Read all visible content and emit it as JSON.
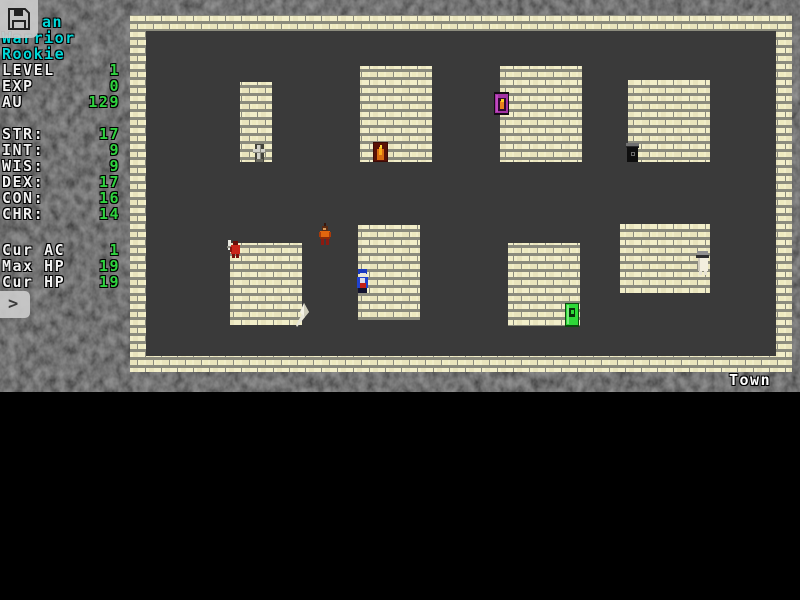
{
  "app": {
    "prompt_char": ">",
    "save_icon": "floppy-disk"
  },
  "colors": {
    "accent_cyan": "#00d9d9",
    "accent_green": "#2fd33f",
    "text_white": "#f2f2f2",
    "brick_light": "#f2eec9",
    "brick_dark": "#e9e4bd",
    "mortar": "#8b8b7d",
    "floor": "#3a3a3a",
    "background": "#141414"
  },
  "sidebar": {
    "prompt_char": ">",
    "title_lines": [
      {
        "text": "an",
        "indent": 40
      },
      {
        "text": "Warrior",
        "indent": 0
      },
      {
        "text": "Rookie",
        "indent": 0
      }
    ],
    "blocks": [
      {
        "top": 62,
        "rows": [
          {
            "label": "LEVEL",
            "value": "1"
          },
          {
            "label": "EXP",
            "value": "0"
          },
          {
            "label": "AU",
            "value": "129"
          }
        ]
      },
      {
        "top": 126,
        "rows": [
          {
            "label": "STR:",
            "value": "17"
          },
          {
            "label": "INT:",
            "value": "9"
          },
          {
            "label": "WIS:",
            "value": "9"
          },
          {
            "label": "DEX:",
            "value": "17"
          },
          {
            "label": "CON:",
            "value": "16"
          },
          {
            "label": "CHR:",
            "value": "14"
          }
        ]
      },
      {
        "top": 242,
        "rows": [
          {
            "label": "Cur AC",
            "value": "1"
          },
          {
            "label": "Max HP",
            "value": "19"
          },
          {
            "label": "Cur HP",
            "value": "19"
          }
        ]
      }
    ]
  },
  "map": {
    "label": "Town",
    "buildings": [
      {
        "x": 110,
        "y": 67,
        "w": 32,
        "h": 80
      },
      {
        "x": 230,
        "y": 51,
        "w": 72,
        "h": 96
      },
      {
        "x": 370,
        "y": 51,
        "w": 82,
        "h": 96
      },
      {
        "x": 498,
        "y": 65,
        "w": 82,
        "h": 82
      },
      {
        "x": 100,
        "y": 228,
        "w": 72,
        "h": 82
      },
      {
        "x": 228,
        "y": 210,
        "w": 62,
        "h": 95
      },
      {
        "x": 378,
        "y": 228,
        "w": 72,
        "h": 83
      },
      {
        "x": 490,
        "y": 209,
        "w": 90,
        "h": 69
      }
    ],
    "entities": [
      {
        "kind": "temple-sign",
        "name": "temple-sign-sprite",
        "x": 122,
        "y": 129
      },
      {
        "kind": "flame-door",
        "name": "flame-door-sprite",
        "x": 243,
        "y": 127
      },
      {
        "kind": "magic-door",
        "name": "magic-door-sprite",
        "x": 364,
        "y": 77
      },
      {
        "kind": "dark-door",
        "name": "dark-door-sprite",
        "x": 496,
        "y": 128
      },
      {
        "kind": "red-npc",
        "name": "red-npc-sprite",
        "x": 97,
        "y": 225
      },
      {
        "kind": "player",
        "name": "player-sprite",
        "x": 188,
        "y": 208
      },
      {
        "kind": "blue-npc",
        "name": "blue-npc-sprite",
        "x": 226,
        "y": 254
      },
      {
        "kind": "white-item",
        "name": "white-item-sprite",
        "x": 166,
        "y": 288
      },
      {
        "kind": "green-door",
        "name": "green-door-sprite",
        "x": 435,
        "y": 288
      },
      {
        "kind": "white-npc",
        "name": "white-npc-sprite",
        "x": 565,
        "y": 236
      }
    ]
  }
}
